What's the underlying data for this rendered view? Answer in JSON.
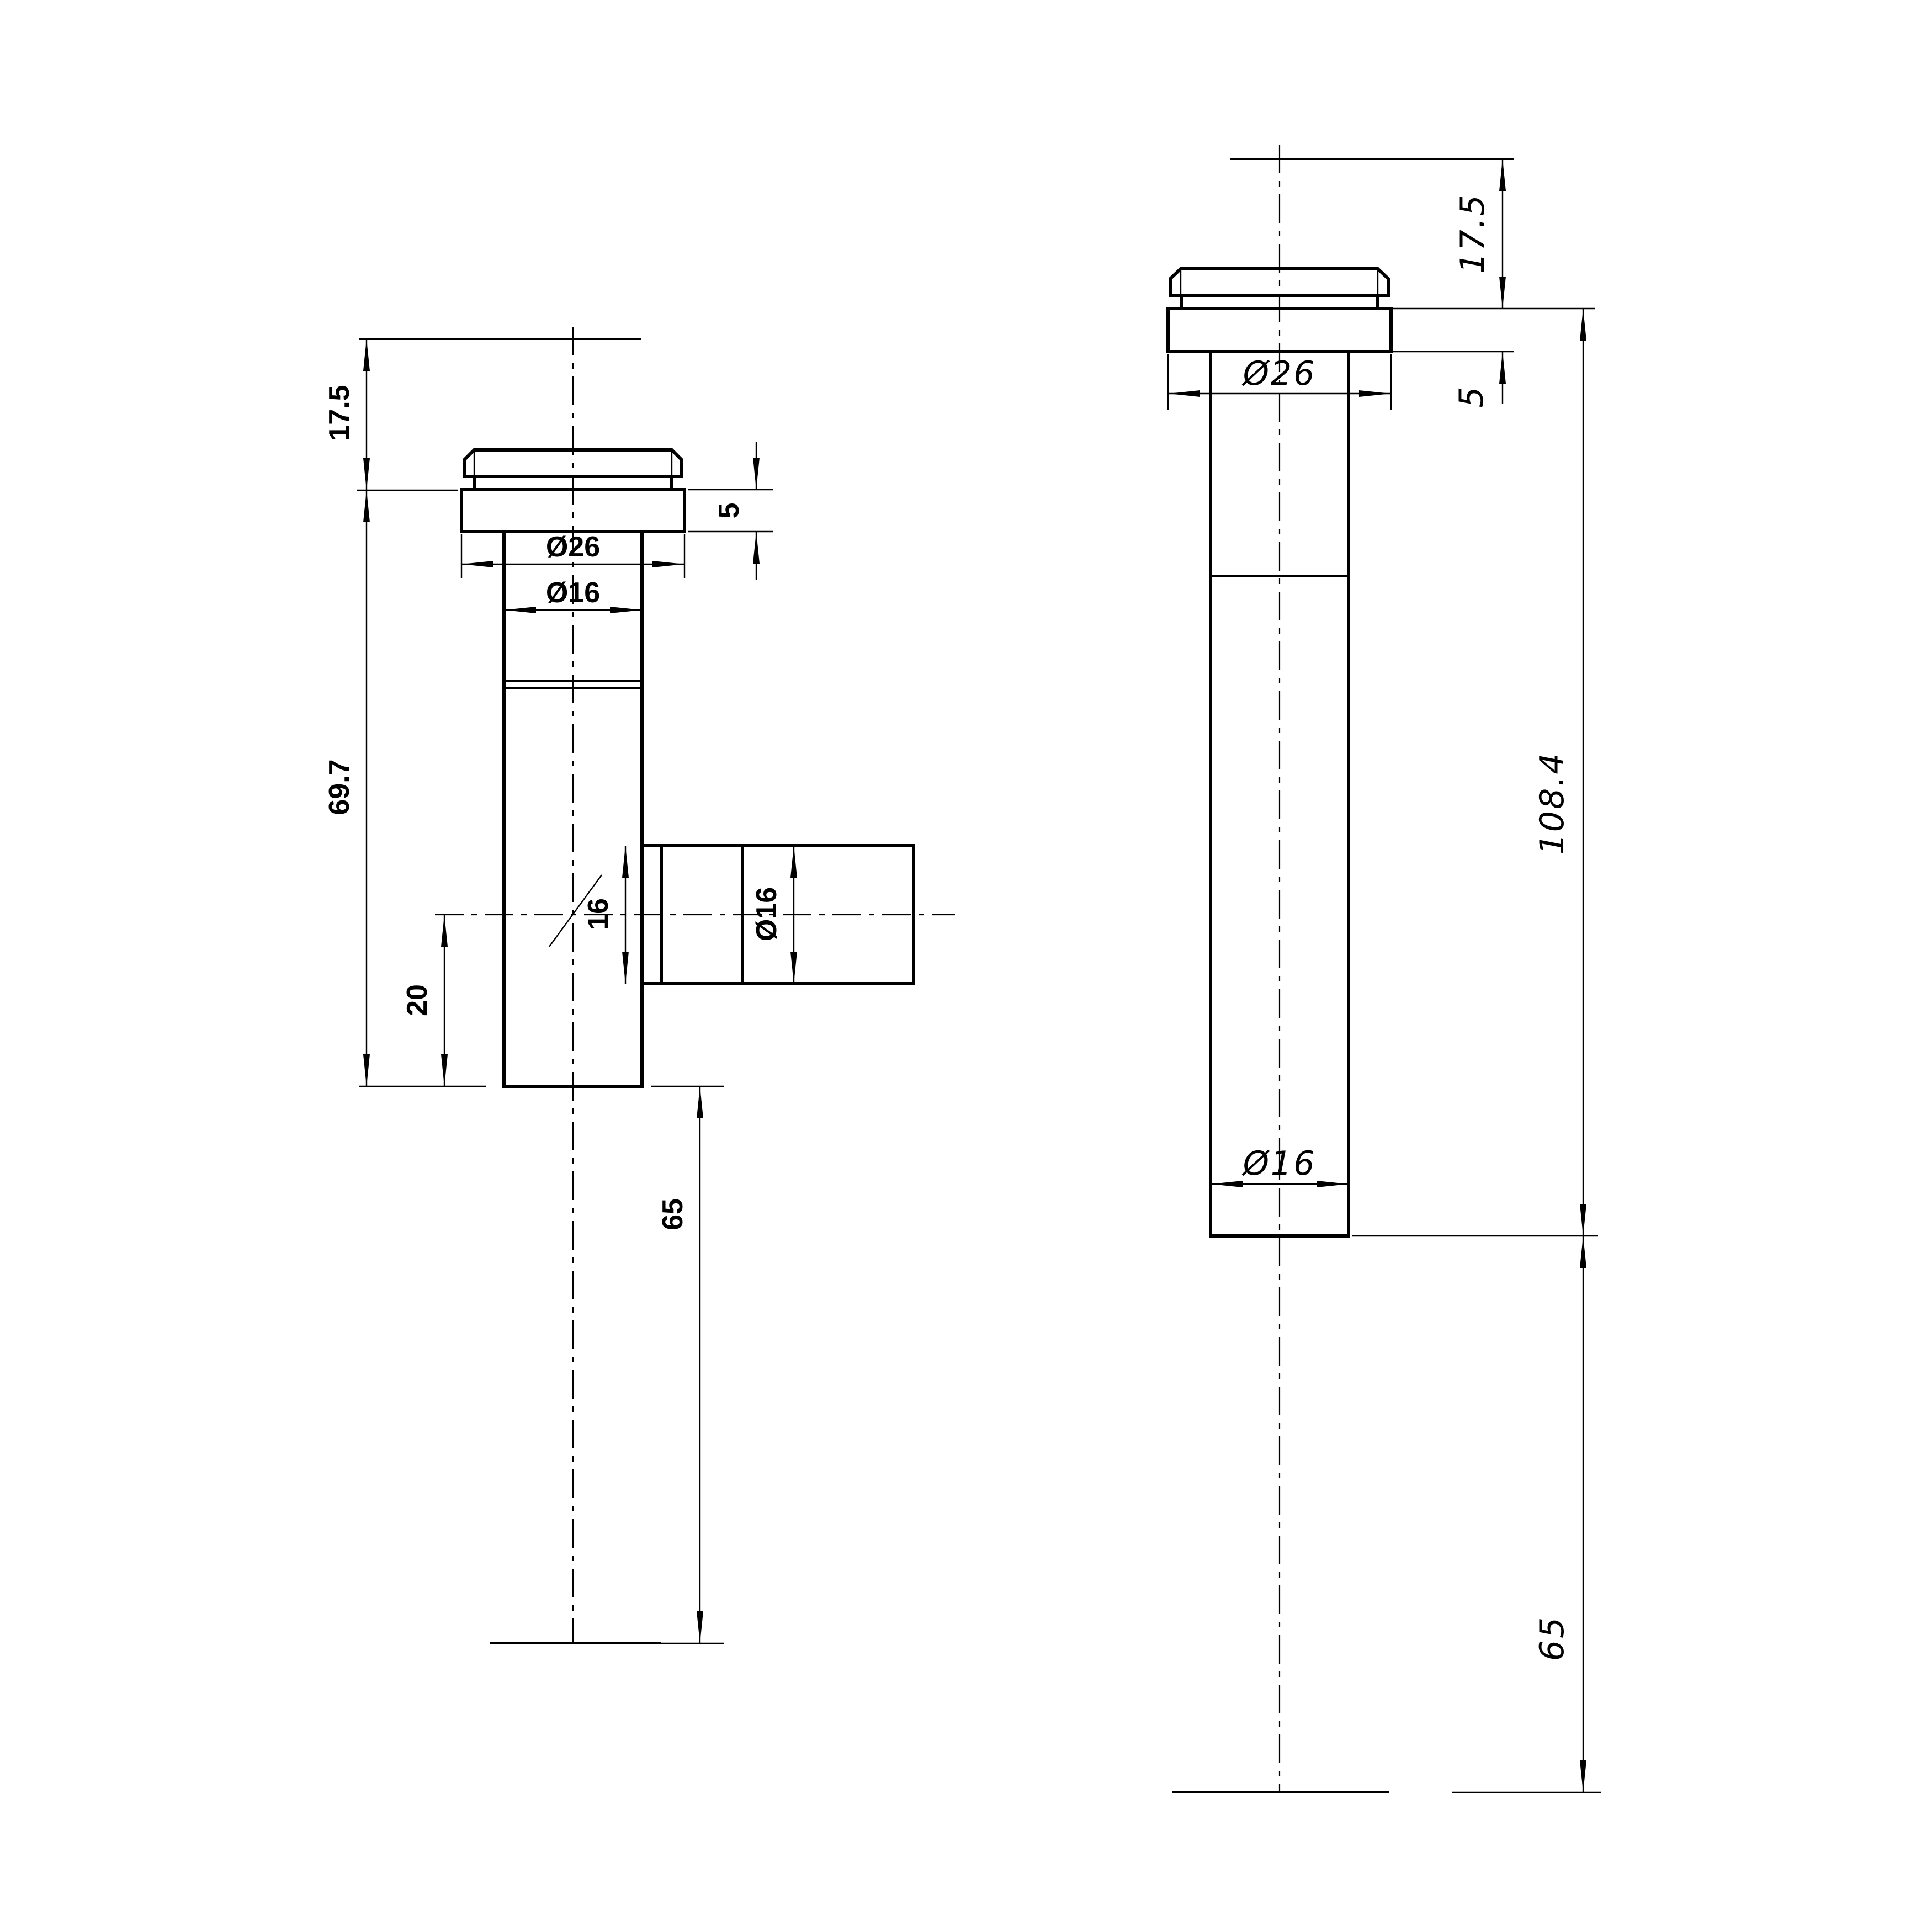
{
  "drawing": {
    "background": "#ffffff",
    "line_color": "#000000",
    "type": "technical-drawing-two-views"
  },
  "left_view": {
    "dims": {
      "top_height": "17.5",
      "body_height": "69.7",
      "branch_center_to_bottom": "20",
      "tail_length": "65",
      "flange_thickness": "5",
      "flange_diameter": "Ø26",
      "shaft_diameter": "Ø16",
      "branch_across": "16",
      "branch_diameter": "Ø16"
    }
  },
  "right_view": {
    "dims": {
      "top_height": "17.5",
      "flange_thickness": "5",
      "flange_diameter": "Ø26",
      "shaft_diameter": "Ø16",
      "overall_height": "108.4",
      "tail_length": "65"
    }
  }
}
